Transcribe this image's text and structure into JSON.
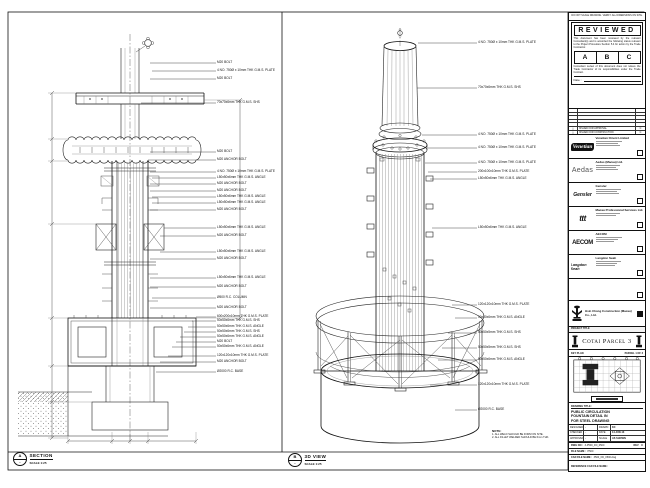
{
  "stamp": {
    "top_note": "DO NOT SCALE DRAWING. VERIFY ALL DIMENSIONS ON SITE.",
    "title": "REVIEWED",
    "body": "This document has been reviewed by the relevant Consultant(s) and is accorded the following status relevant  to the Project Procedure Section 5.4 for action by the Trade Contractor.",
    "status_boxes": [
      "A",
      "B",
      "C"
    ],
    "footer": "Consultant review of this document does not relieve the Trade Contractor of its responsibilities under the Trade Contract.",
    "date_label": "Date :"
  },
  "revisions": [
    {
      "mark": "△",
      "desc": "ISSUED FOR APPROVAL",
      "by": "C"
    },
    {
      "mark": "△",
      "desc": "ISSUED FOR CONSTRUCTION",
      "by": "C"
    }
  ],
  "consultants": [
    {
      "logo": "Venetian",
      "name": "Venetian Orient Limited"
    },
    {
      "logo": "Aedas",
      "name": "Aedas (Macau) Ltd."
    },
    {
      "logo": "Gensler",
      "name": "Gensler"
    },
    {
      "logo": "ttt",
      "name": "Macau Professional Services Ltd."
    },
    {
      "logo": "AECOM",
      "name": "AECOM"
    },
    {
      "logo": "Langdon Seah",
      "name": "Langdon Seah"
    }
  ],
  "contractor": {
    "name": "Hsin Chong Construction (Macau) Co., Ltd."
  },
  "project": {
    "label": "PROJECT TITLE",
    "name": "Cotai Parcel 3"
  },
  "key_plan": {
    "label": "KEY PLAN",
    "parcel": "PARCEL 1 OF 3"
  },
  "drawing": {
    "label": "DRAWING TITLE:",
    "line1": "PUBLIC CIRCULATION",
    "line2": "FOUNTAIN DETAIL IN",
    "line3": "FOR STEEL DRAWING"
  },
  "info": {
    "designed_label": "DESIGNED",
    "designed": "-",
    "drawn_label": "DRAWN",
    "drawn": "KC",
    "checked_label": "CHECKED",
    "checked": "-",
    "date_label": "DATE",
    "date": "14-JUN-13",
    "approved_label": "APPROVED",
    "approved": "-",
    "scale_label": "SCALE",
    "scale": "AS SHOWN",
    "dwg_label": "DWG NO :",
    "dwg_no": "3-P500_FD_0500",
    "rev_label": "REV",
    "rev": "C",
    "file_label": "FILE NAME :",
    "file": "P500",
    "cad_label": "CAD FILE NAME :",
    "cad": "3500_FD_0500.dwg",
    "ref_label": "REFERENCE CAD FILE NAME :",
    "ref": ""
  },
  "views": {
    "section": {
      "bubble": "A",
      "sheet": "-",
      "title": "SECTION",
      "scale": "SCALE 1:25"
    },
    "iso": {
      "bubble": "B",
      "sheet": "-",
      "title": "3D VIEW",
      "scale": "SCALE 1:25"
    }
  },
  "notes": {
    "title": "NOTE:",
    "items": [
      "1. ALL WELD SHOULD BE FORM ON SITE.",
      "2. ALL FILLET WELDED SHOULD BE 6mm THK."
    ]
  },
  "section_labels": [
    {
      "t": "M20 BOLT",
      "x": 217,
      "y": 63,
      "tx": 150
    },
    {
      "t": "4 NO. 750Ø x 10mm THK G.M.S. PLATE",
      "x": 217,
      "y": 71,
      "tx": 152
    },
    {
      "t": "M20 BOLT",
      "x": 217,
      "y": 79,
      "tx": 150
    },
    {
      "t": "70x70x6mm THK G.M.S. SHS",
      "x": 217,
      "y": 103,
      "tx": 141
    },
    {
      "t": "M20 BOLT",
      "x": 217,
      "y": 152,
      "tx": 150
    },
    {
      "t": "M20 ANCHOR BOLT",
      "x": 217,
      "y": 160,
      "tx": 148
    },
    {
      "t": "4 NO. 750Ø x 10mm THK G.M.S. PLATE",
      "x": 217,
      "y": 172,
      "tx": 150
    },
    {
      "t": "L50x50x6mm THK G.M.S. ANGLE",
      "x": 217,
      "y": 178,
      "tx": 152
    },
    {
      "t": "M20 ANCHOR BOLT",
      "x": 217,
      "y": 184,
      "tx": 150
    },
    {
      "t": "M20 ANCHOR BOLT",
      "x": 217,
      "y": 191,
      "tx": 150
    },
    {
      "t": "L50x50x6mm THK G.M.S. ANGLE",
      "x": 217,
      "y": 197,
      "tx": 152
    },
    {
      "t": "L50x50x6mm THK G.M.S. ANGLE",
      "x": 217,
      "y": 203,
      "tx": 152
    },
    {
      "t": "M20 ANCHOR BOLT",
      "x": 217,
      "y": 210,
      "tx": 150
    },
    {
      "t": "L50x50x6mm THK G.M.S. ANGLE",
      "x": 217,
      "y": 228,
      "tx": 164
    },
    {
      "t": "M20 ANCHOR BOLT",
      "x": 217,
      "y": 236,
      "tx": 160
    },
    {
      "t": "L50x50x6mm THK G.M.S. ANGLE",
      "x": 217,
      "y": 252,
      "tx": 160
    },
    {
      "t": "M20 ANCHOR BOLT",
      "x": 217,
      "y": 259,
      "tx": 150
    },
    {
      "t": "L50x50x6mm THK G.M.S. ANGLE",
      "x": 217,
      "y": 278,
      "tx": 150
    },
    {
      "t": "M20 ANCHOR BOLT",
      "x": 217,
      "y": 287,
      "tx": 150
    },
    {
      "t": "Ø500 R.C. COLUMN",
      "x": 217,
      "y": 298,
      "tx": 152
    },
    {
      "t": "M20 ANCHOR BOLT",
      "x": 217,
      "y": 308,
      "tx": 150
    },
    {
      "t": "600x200x10mm THK G.M.S. PLATE",
      "x": 217,
      "y": 317,
      "tx": 196
    },
    {
      "t": "50x50x6mm THK G.M.S. SHS",
      "x": 217,
      "y": 321,
      "tx": 192
    },
    {
      "t": "50x50x6mm THK G.M.S. ANGLE",
      "x": 217,
      "y": 327,
      "tx": 188
    },
    {
      "t": "50x50x6mm THK G.M.S. SHS",
      "x": 217,
      "y": 332,
      "tx": 184
    },
    {
      "t": "50x50x6mm THK G.M.S. ANGLE",
      "x": 217,
      "y": 337,
      "tx": 180
    },
    {
      "t": "M20 BOLT",
      "x": 217,
      "y": 342,
      "tx": 176
    },
    {
      "t": "50x50x6mm THK G.M.S. ANGLE",
      "x": 217,
      "y": 347,
      "tx": 172
    },
    {
      "t": "120x120x10mm THK G.M.S. PLATE",
      "x": 217,
      "y": 356,
      "tx": 168
    },
    {
      "t": "M20 ANCHOR BOLT",
      "x": 217,
      "y": 362,
      "tx": 160
    },
    {
      "t": "Ø2000 R.C. BASE",
      "x": 217,
      "y": 372,
      "tx": 156
    }
  ],
  "iso_labels": [
    {
      "t": "4 NO. 750Ø x 10mm THK G.M.S. PLATE",
      "x": 478,
      "y": 43,
      "tx": 418
    },
    {
      "t": "70x70x6mm THK G.M.S. SHS",
      "x": 478,
      "y": 88,
      "tx": 417
    },
    {
      "t": "4 NO. 750Ø x 10mm THK G.M.S. PLATE",
      "x": 478,
      "y": 135,
      "tx": 422
    },
    {
      "t": "4 NO. 750Ø x 10mm THK G.M.S. PLATE",
      "x": 478,
      "y": 148,
      "tx": 428
    },
    {
      "t": "4 NO. 750Ø x 10mm THK G.M.S. PLATE",
      "x": 478,
      "y": 163,
      "tx": 425
    },
    {
      "t": "200x100x10mm THK G.M.S. PLATE",
      "x": 478,
      "y": 172,
      "tx": 428
    },
    {
      "t": "L50x50x6mm THK G.M.S. ANGLE",
      "x": 478,
      "y": 179,
      "tx": 430
    },
    {
      "t": "L50x50x6mm THK G.M.S. ANGLE",
      "x": 478,
      "y": 228,
      "tx": 432
    },
    {
      "t": "120x120x10mm THK G.M.S. PLATE",
      "x": 478,
      "y": 305,
      "tx": 452
    },
    {
      "t": "50x50x6mm THK G.M.S. ANGLE",
      "x": 478,
      "y": 318,
      "tx": 455
    },
    {
      "t": "50x50x5mm THK G.M.S. SHS",
      "x": 478,
      "y": 333,
      "tx": 448
    },
    {
      "t": "50x50x5mm THK G.M.S. SHS",
      "x": 478,
      "y": 348,
      "tx": 442
    },
    {
      "t": "50x50x6mm THK G.M.S. ANGLE",
      "x": 478,
      "y": 360,
      "tx": 438
    },
    {
      "t": "120x120x10mm THK G.M.S. PLATE",
      "x": 478,
      "y": 385,
      "tx": 430
    },
    {
      "t": "Ø2000 R.C. BASE",
      "x": 478,
      "y": 410,
      "tx": 455
    }
  ]
}
